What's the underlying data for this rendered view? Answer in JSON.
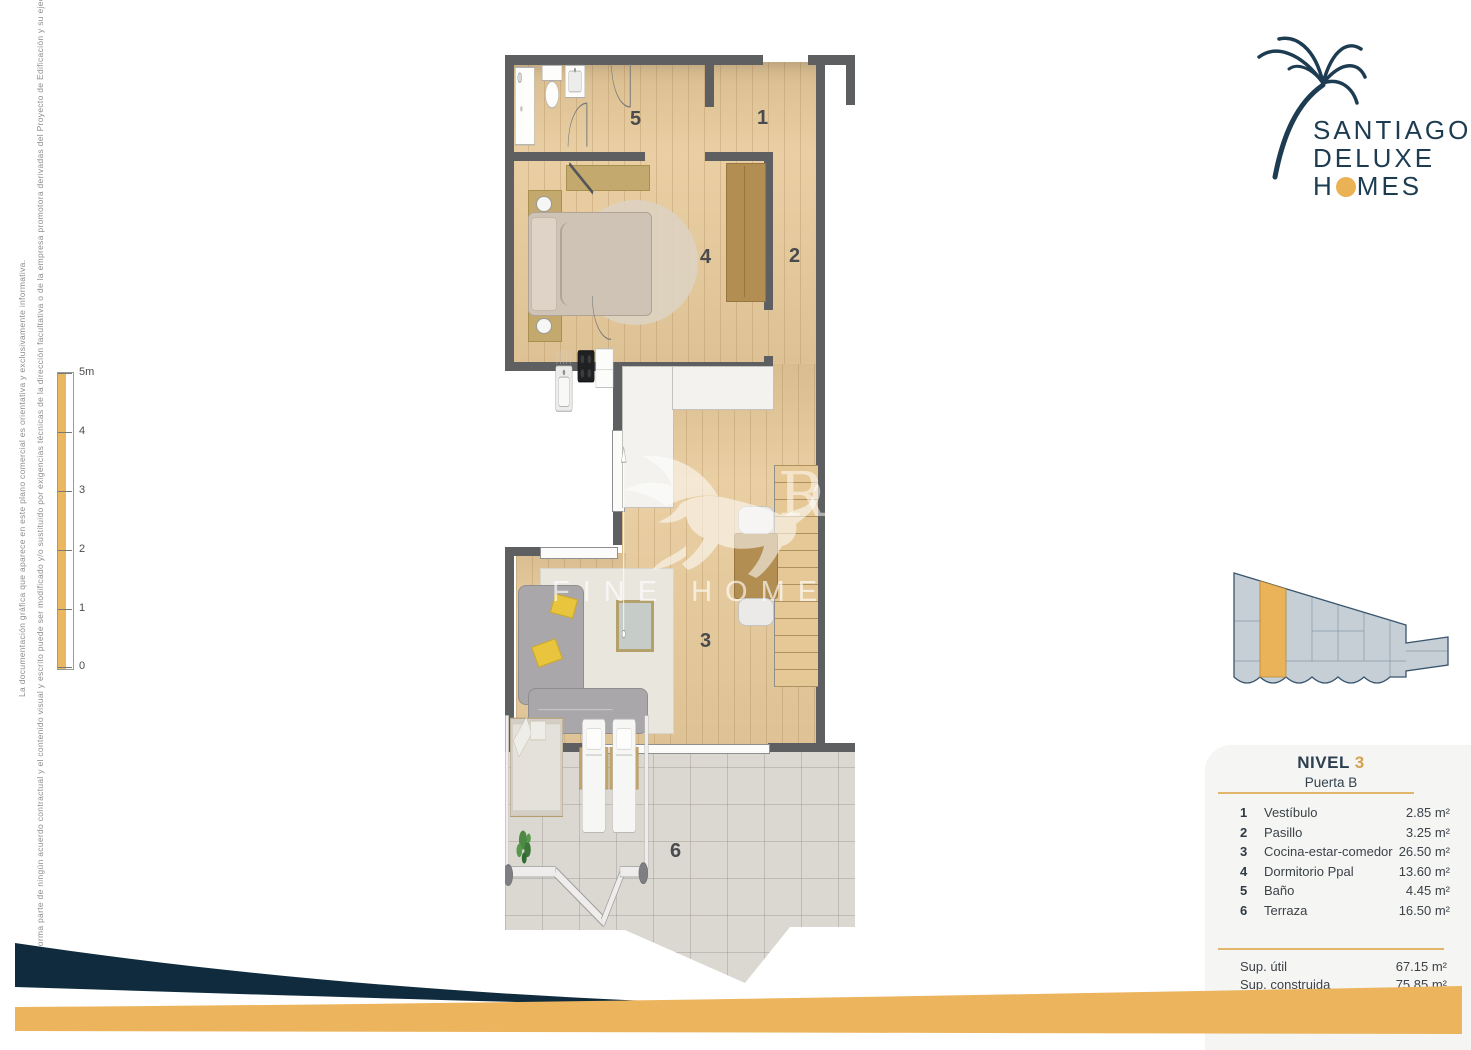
{
  "branding": {
    "line1": "SANTIAGO",
    "line2": "DELUXE",
    "line3_pre": "H",
    "line3_post": "MES",
    "navy": "#1d3c52",
    "gold": "#eab255"
  },
  "watermark": {
    "left_fragment": "sion",
    "right_fragment": "Realty",
    "tagline": "FINE HOMES & VILLAS"
  },
  "disclaimer": {
    "line1": "La documentación gráfica que aparece en este plano comercial es orientativa y exclusivamente informativa.",
    "line2": "No forma parte de ningún acuerdo contractual y el contenido visual y escrito puede ser modificado y/o sustituido por exigencias técnicas de la dirección facultativa o de la empresa promotora derivadas del Proyecto de Edificación y su ejecución."
  },
  "scale_bar": {
    "labels": [
      "5m",
      "4",
      "3",
      "2",
      "1",
      "0"
    ]
  },
  "unit": {
    "level_label": "NIVEL",
    "level_number": "3",
    "door_label": "Puerta B"
  },
  "rooms": [
    {
      "num": "1",
      "name": "Vestíbulo",
      "area": "2.85 m²"
    },
    {
      "num": "2",
      "name": "Pasillo",
      "area": "3.25 m²"
    },
    {
      "num": "3",
      "name": "Cocina-estar-comedor",
      "area": "26.50 m²"
    },
    {
      "num": "4",
      "name": "Dormitorio Ppal",
      "area": "13.60 m²"
    },
    {
      "num": "5",
      "name": "Baño",
      "area": "4.45 m²"
    },
    {
      "num": "6",
      "name": "Terraza",
      "area": "16.50 m²"
    }
  ],
  "totals": [
    {
      "label": "Sup. útil",
      "value": "67.15 m²"
    },
    {
      "label": "Sup. construida",
      "value": "75.85 m²"
    }
  ],
  "key_plan": {
    "highlight_color": "#eab259",
    "building_fill": "#c6cfd6",
    "outline": "#39556e"
  },
  "colors": {
    "wall": "#5e5f61",
    "wood_floor": "#e9cfa3",
    "accent_gold": "#ecb45c",
    "navy_band": "#0f2b3d"
  }
}
